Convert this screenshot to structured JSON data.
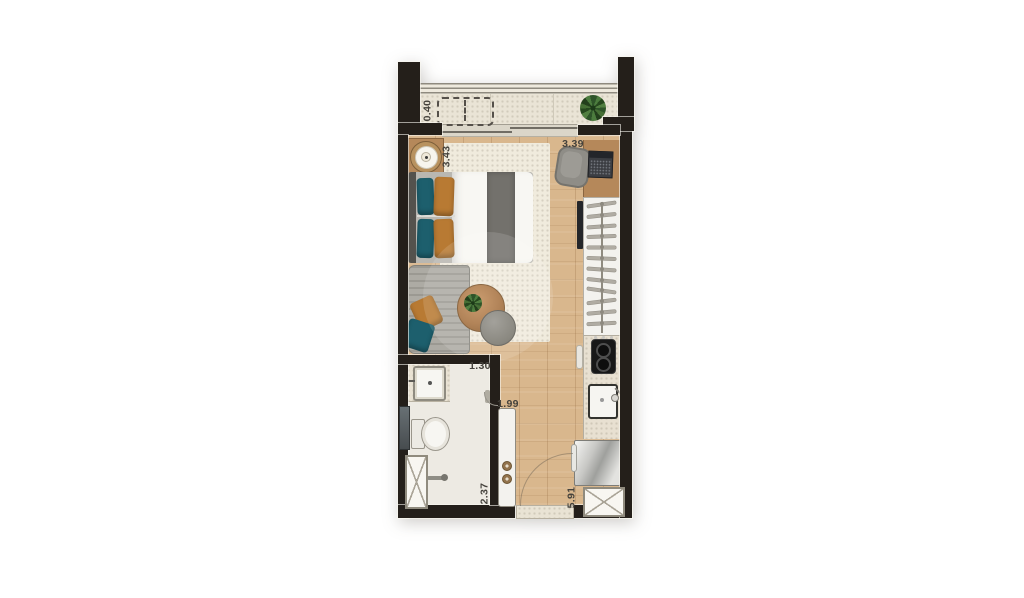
{
  "floorplan": {
    "type": "studio-apartment-floor-plan",
    "dimension_labels": {
      "balcony_depth": "0.40",
      "bedroom_width": "3.43",
      "study_wall": "3.39",
      "bathroom_width": "1.30",
      "hall_width": "1.99",
      "bathroom_depth": "2.37",
      "unit_depth": "5.91"
    },
    "closet": {
      "hanger_count": 12
    },
    "cooktop_burners": 2,
    "elements": [
      "balcony-railing",
      "balcony-planter",
      "potted-plant",
      "sliding-glass-door",
      "nightstand",
      "table-lamp",
      "double-bed",
      "pillows",
      "area-rug",
      "chaise-sofa",
      "round-table",
      "table-plant",
      "pouf",
      "desk",
      "desk-chair",
      "laptop",
      "wardrobe-closet",
      "tv-panel",
      "kitchen-counter",
      "cooktop",
      "kitchen-sink",
      "refrigerator",
      "service-shaft",
      "bathroom-vanity",
      "washbasin",
      "toilet",
      "towel-bar",
      "glass-panel",
      "sliding-door-panel",
      "entrance-door"
    ],
    "colors": {
      "wall": "#241f1a",
      "wood_floor": "#d9b78d",
      "balcony_floor": "#eae4d6",
      "bathroom_tile": "#edeae3",
      "rug": "#f0ebdd",
      "furniture_wood": "#b5885a",
      "pillow_teal": "#1d5f6d",
      "pillow_orange": "#b87a33"
    }
  }
}
